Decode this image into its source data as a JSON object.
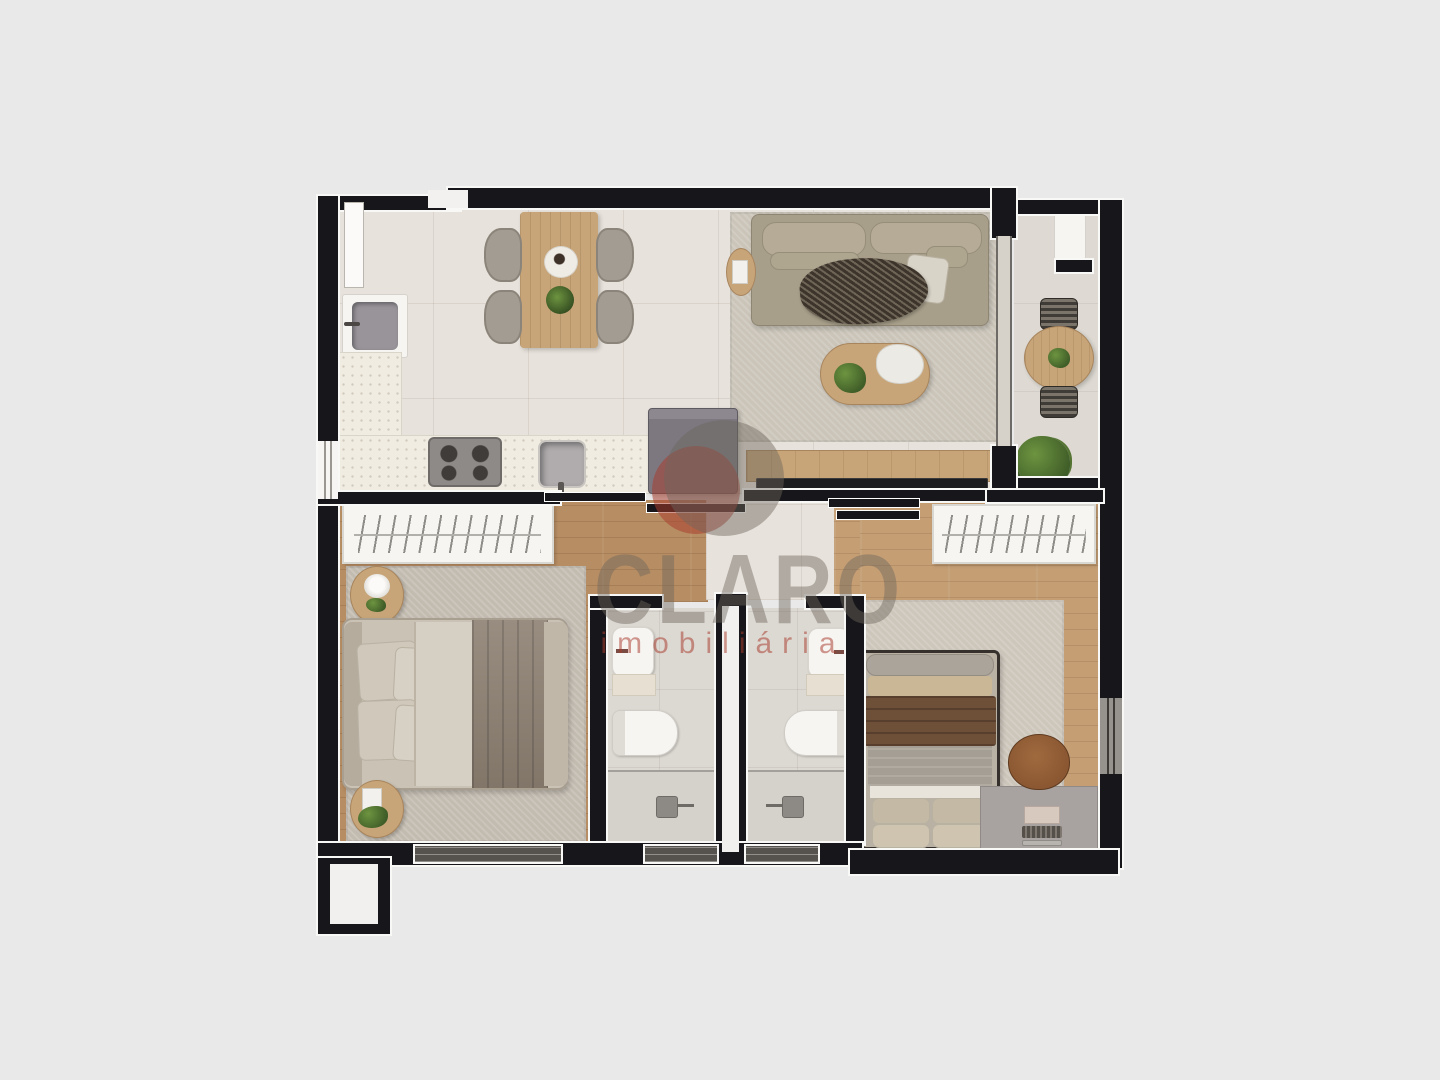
{
  "watermark": {
    "brand": "CLARO",
    "subtitle": "imobiliária"
  },
  "palette": {
    "bg": "#e9e9e9",
    "wall": "#17161a",
    "trim": "#f8f8f6",
    "tile": "#e7e2db",
    "tileLine": "rgba(125,110,95,0.13)",
    "wood1": "#b78d63",
    "wood2": "#c59e74",
    "woodFurn": "#c7a578",
    "counter": "#f0ece2",
    "rugLiving": "#cac4b9",
    "rugBed1": "#c2bbb0",
    "rugBed2": "#cdc6bb",
    "sofa": "#a89f8a",
    "sofaCushion": "#b5ab96",
    "pillowLight": "#d9d4c8",
    "throwA": "#3d352c",
    "throwB": "#6f6557",
    "fixture": "#f6f5f2",
    "appliance": "#7d7880",
    "basin": "#98949a",
    "bed1Base": "#c9c2b5",
    "bed1Blanket": "#8d8072",
    "bed2Brown": "#6e4f38",
    "bed2Duvet": "#a59e94",
    "beddingTan": "#c9b795",
    "desk": "#a8a2a0",
    "chairBrown": "#8a5732",
    "plantLight": "#6d9440",
    "plantDark": "#3f5d28",
    "windowDark": "#56524e",
    "glass": "#d6d2ca",
    "bathFloor": "#dcd8d2",
    "wmGray": "rgba(108,102,94,0.45)",
    "wmRed": "rgba(168,60,45,0.52)"
  }
}
